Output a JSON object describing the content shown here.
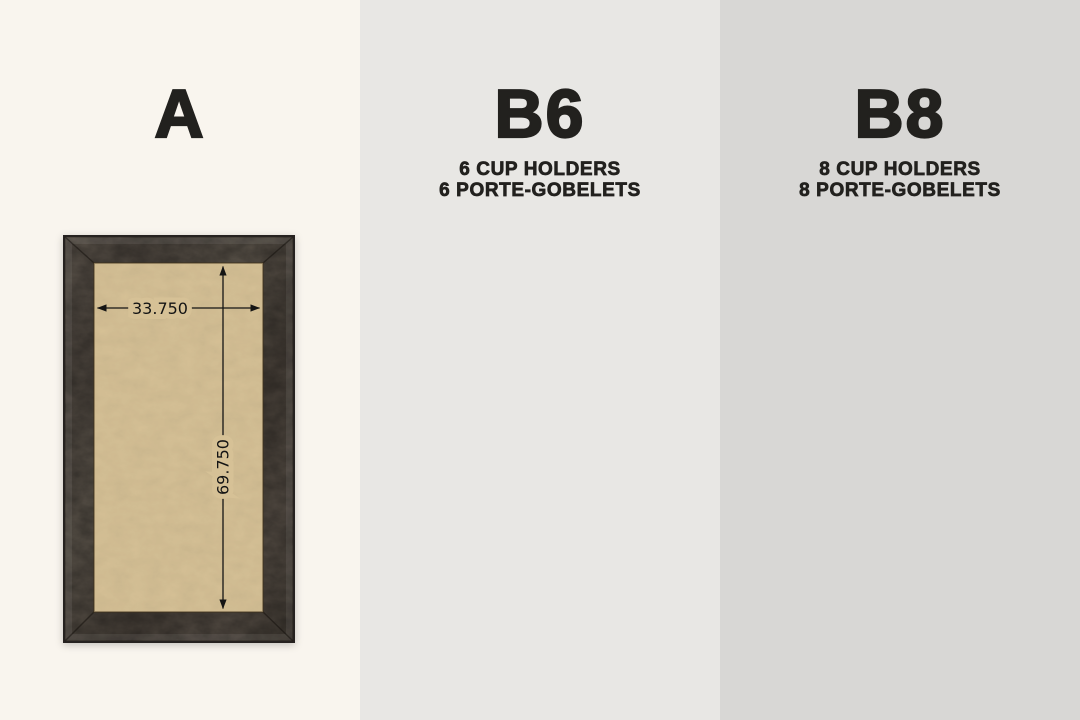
{
  "panels": [
    {
      "id": "a",
      "title": "A",
      "subtitle_lines": [],
      "cup_holders": 0,
      "dimensions": {
        "width": "33.750",
        "height": "69.750"
      }
    },
    {
      "id": "b6",
      "title": "B6",
      "subtitle_lines": [
        "6 CUP HOLDERS",
        "6 PORTE-GOBELETS"
      ],
      "cup_holders": 6,
      "dimensions": {
        "width": "24.500",
        "height": "60.500"
      }
    },
    {
      "id": "b8",
      "title": "B8",
      "subtitle_lines": [
        "8 CUP HOLDERS",
        "8 PORTE-GOBELETS"
      ],
      "cup_holders": 8,
      "dimensions": {
        "width": "24.500",
        "height": "60.500"
      }
    }
  ],
  "colors": {
    "panel_a_bg": "#f9f5ee",
    "panel_b6_bg": "#e8e7e4",
    "panel_b8_bg": "#d8d7d5",
    "title_text": "#22211e",
    "dimension_text": "#141414",
    "wood_frame": "#4b443c",
    "rail": "#6d655b",
    "felt": "#d6c196",
    "cup_holder": "#f4f4f0"
  }
}
